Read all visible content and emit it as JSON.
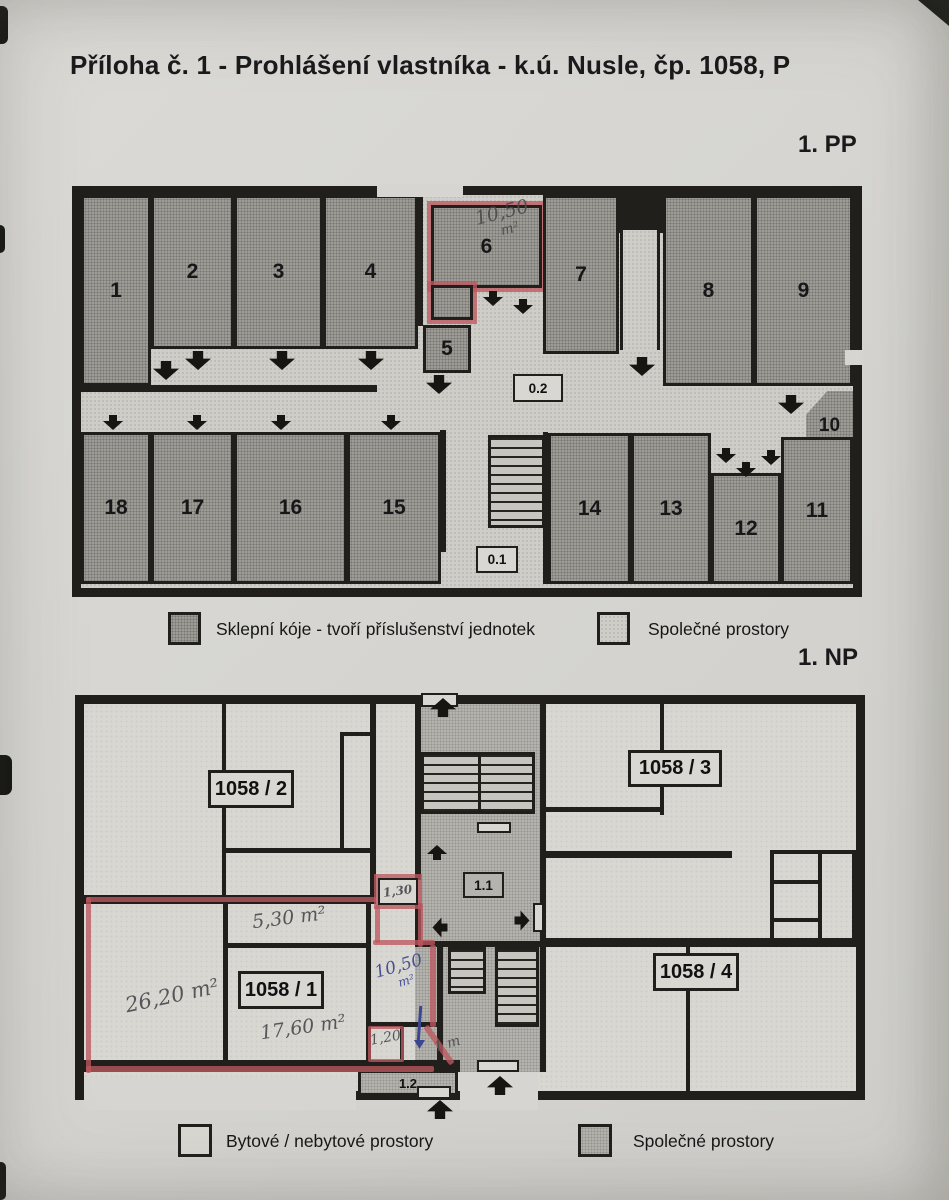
{
  "page": {
    "title": "Příloha č. 1 - Prohlášení vlastníka - k.ú. Nusle, čp. 1058, P",
    "floor_basement_label": "1. PP",
    "floor_ground_label": "1. NP"
  },
  "basement": {
    "rooms": [
      "1",
      "2",
      "3",
      "4",
      "5",
      "6",
      "7",
      "8",
      "9",
      "10",
      "11",
      "12",
      "13",
      "14",
      "15",
      "16",
      "17",
      "18"
    ],
    "corridor_main": "0.2",
    "corridor_stairs": "0.1",
    "annotation_room6": {
      "value": "10,50",
      "unit": "m²"
    },
    "legend": [
      {
        "label": "Sklepní kóje - tvoří příslušenství jednotek"
      },
      {
        "label": "Společné prostory"
      }
    ]
  },
  "ground": {
    "units": {
      "u1": "1058 / 1",
      "u2": "1058 / 2",
      "u3": "1058 / 3",
      "u4": "1058 / 4"
    },
    "common_hall": "1.1",
    "common_vestibule": "1.2",
    "annotations": {
      "niche": {
        "value": "1,30",
        "unit": "m²"
      },
      "room_main": "26,20 m²",
      "room_small": "5,30 m²",
      "room_mid": "17,60 m²",
      "strip": {
        "value": "10,50",
        "unit": "m²"
      },
      "width_a": "1,20",
      "width_b": "1 m"
    },
    "legend": [
      {
        "label": "Bytové / nebytové prostory"
      },
      {
        "label": "Společné prostory"
      }
    ]
  }
}
